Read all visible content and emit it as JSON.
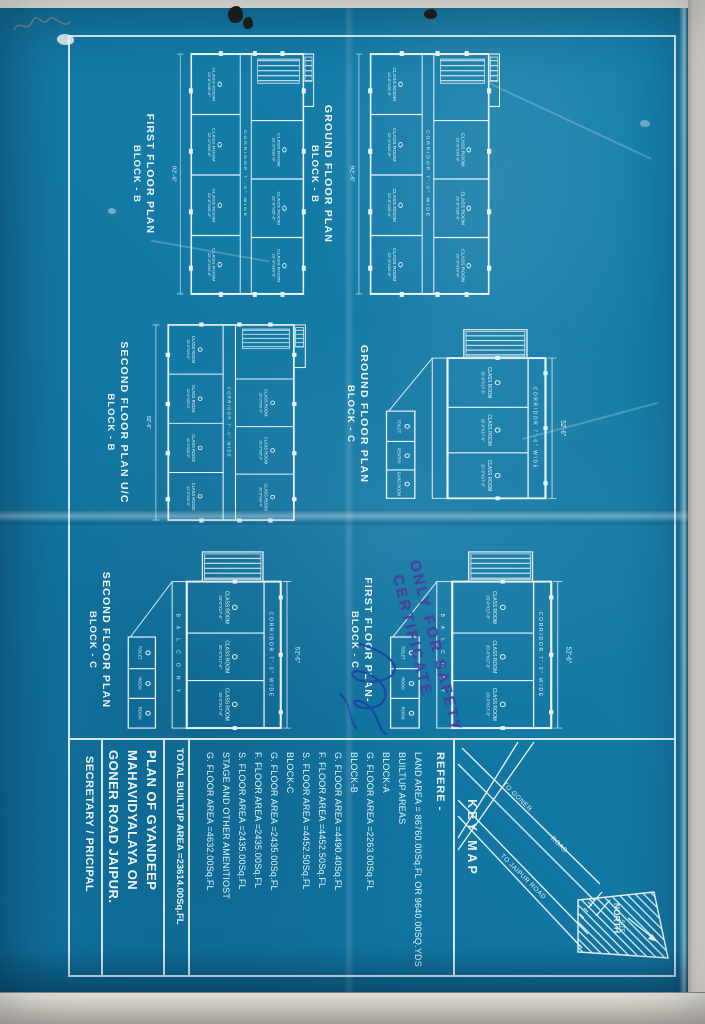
{
  "colors": {
    "blueprint_blue": "#147dab",
    "line_white": "#e9f4f8",
    "paper": "#d9d5cd",
    "stamp_purple": "#4c3a9e",
    "ink_blue": "#1b3da8"
  },
  "plans": {
    "b_ground": {
      "title1": "GROUND FLOOR PLAN",
      "title2": "BLOCK - B"
    },
    "b_first": {
      "title1": "FIRST FLOOR PLAN",
      "title2": "BLOCK - B"
    },
    "b_second": {
      "title1": "SECOND FLOOR PLAN U/C",
      "title2": "BLOCK - B"
    },
    "c_ground": {
      "title1": "GROUND FLOOR PLAN",
      "title2": "BLOCK - C"
    },
    "c_first": {
      "title1": "FIRST FLOOR PLAN-",
      "title2": "BLOCK - C"
    },
    "c_second": {
      "title1": "SECOND FLOOR PLAN",
      "title2": "BLOCK - C"
    }
  },
  "labels": {
    "corridor": "CORRIDOR 7'-0\" WIDE",
    "class_room": "CLASS ROOM",
    "room_dim_b": "22'-0\"X20'-0\"",
    "room_dim_c": "20'-0\"X17'-6\"",
    "balcony": "B A L C O N Y",
    "toilet": "TOILET",
    "pentry": "PENTRY",
    "gard_room": "GARD ROOM",
    "room": "ROOM",
    "dim_b_width": "92'-6\"",
    "dim_c_width": "52'-6\""
  },
  "title_block": {
    "key_map": {
      "title": "KEY MAP",
      "north": "NORTH",
      "site": "SITE",
      "road_goner": "TO GONER",
      "road": "ROAD",
      "road_jaipur": "TO JAIPUR ROAD"
    },
    "reference": {
      "heading": "REFERE -",
      "lines": [
        "LAND AREA = 86760.00Sq.FL OR 9640.00SQ.YDS",
        "BUILTUP AREAS",
        "BLOCK-A",
        "G. FLOOR AREA =2263.00Sq.FL",
        "BLOCK-B",
        "G. FLOOR AREA =4490.40Sq.FL",
        "F. FLOOR AREA =4452.50Sq.FL",
        "S. FLOOR AREA =4452.50Sq.FL",
        "BLOCK-C",
        "G. FLOOR AREA =2435.00Sq.FL",
        "F. FLOOR AREA =2435.00Sq.FL",
        "S. FLOOR AREA =2435.00Sq.FL",
        "STAGE AND OTHER AMENITIOST",
        "G. FLOOR AREA =4632.00Sq.FL"
      ]
    },
    "total": "TOTAL BUILTUP AREA =23614.00Sq.FL",
    "project": {
      "line1": "PLAN OF GYANDEEP",
      "line2": "MAHAVIDYALAYA ON",
      "line3": "GONER ROAD JAIPUR."
    },
    "signatory": "SECRETARY / PRICIPAL"
  },
  "stamp": {
    "line1": "ONLY FOR SAFETY",
    "line2": "CERTIFICATE"
  }
}
